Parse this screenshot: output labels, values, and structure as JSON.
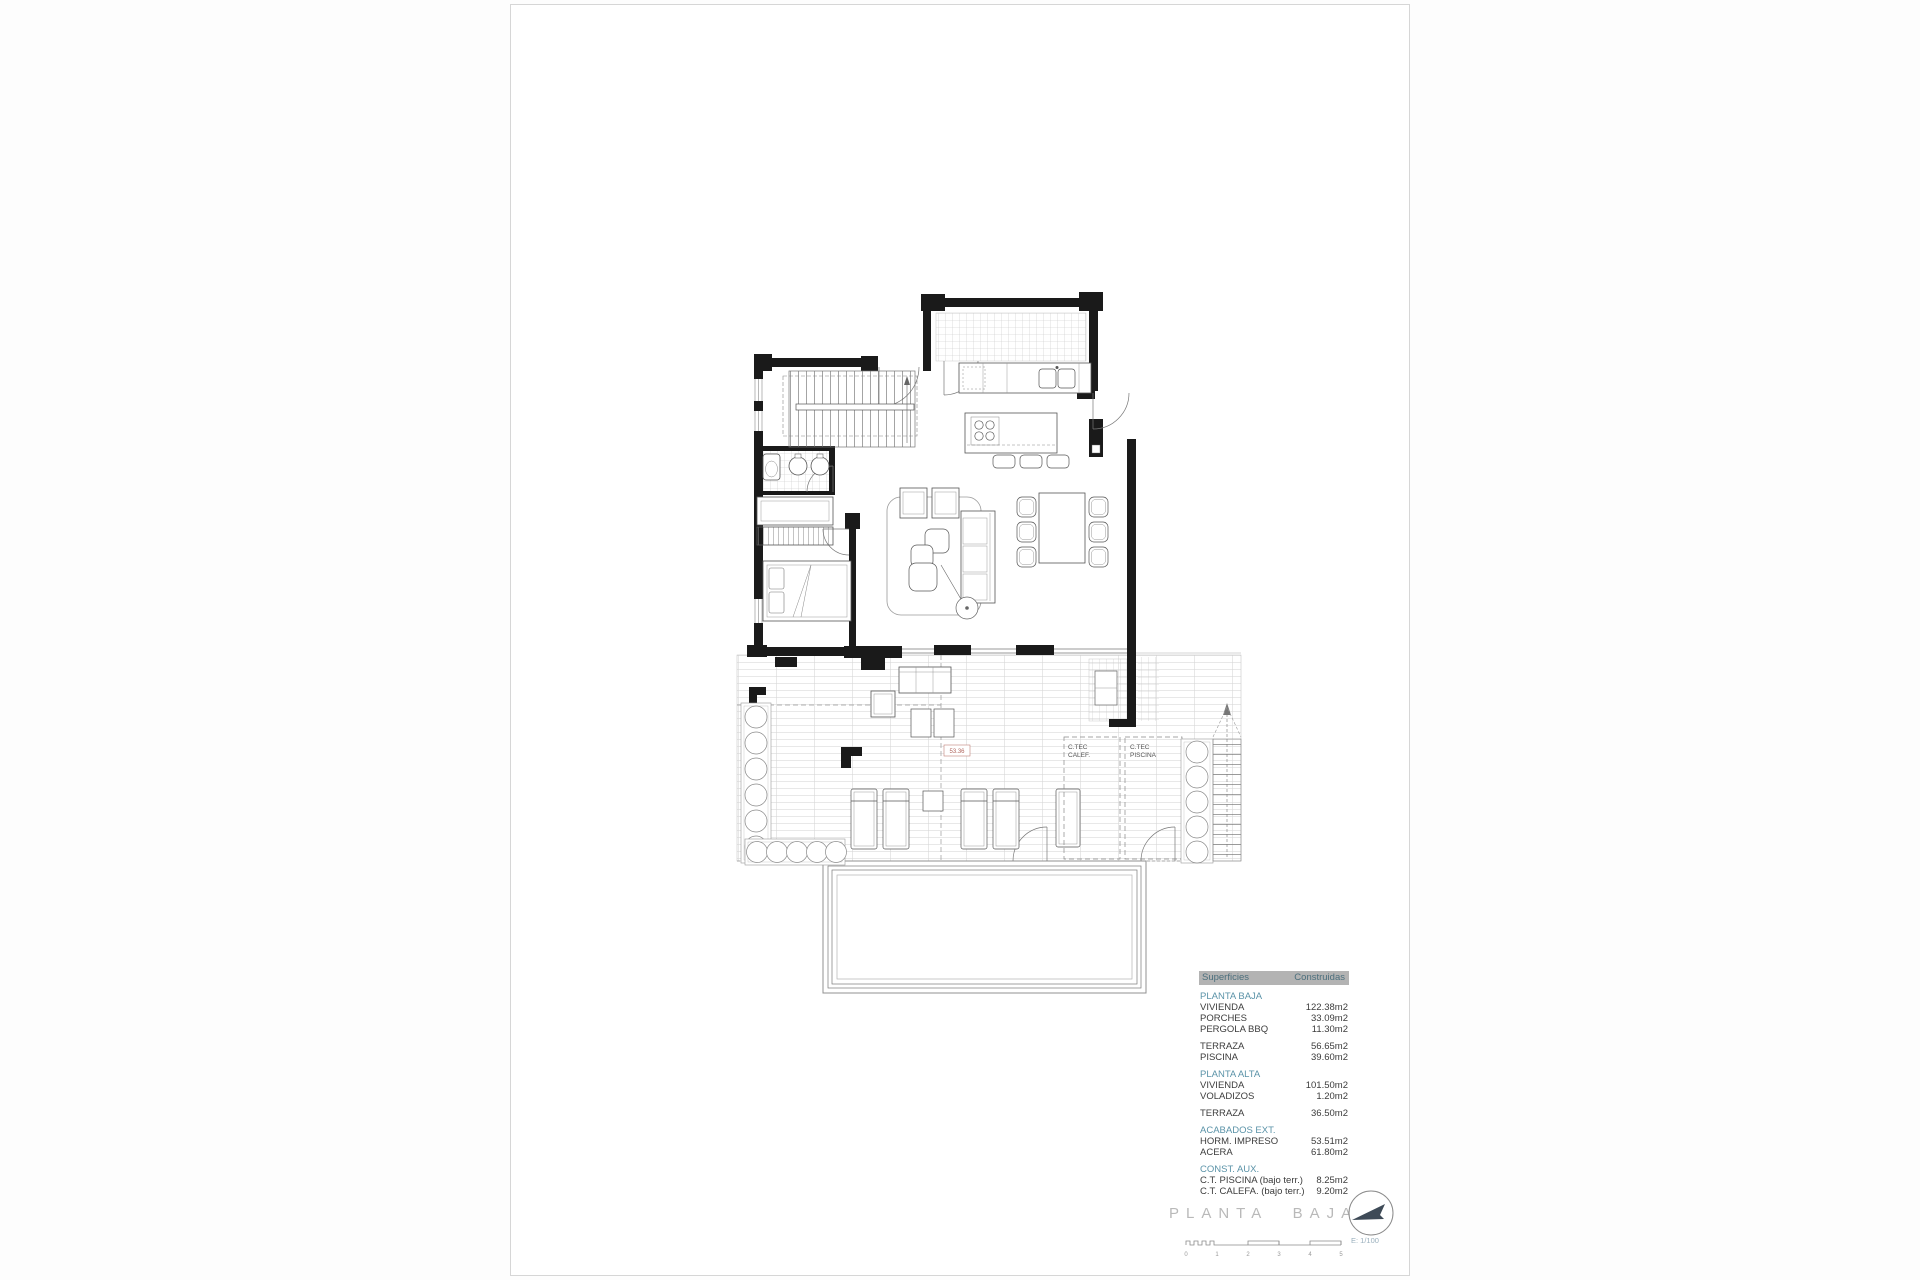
{
  "document": {
    "sheet_title": "PLANTA BAJA",
    "scale_label": "E: 1/100",
    "scale_ticks": [
      "0",
      "1",
      "2",
      "3",
      "4",
      "5"
    ]
  },
  "plan_labels": {
    "level_mark": "53.36",
    "room_calefaccion_line1": "C.TEC",
    "room_calefaccion_line2": "CALEF.",
    "room_piscina_line1": "C.TEC",
    "room_piscina_line2": "PISCINA"
  },
  "surfaces_table": {
    "col_superficies": "Superficies",
    "col_construidas": "Construidas",
    "rows": [
      {
        "type": "heading",
        "label": "PLANTA BAJA",
        "value": ""
      },
      {
        "type": "row",
        "label": "VIVIENDA",
        "value": "122.38m2"
      },
      {
        "type": "row",
        "label": "PORCHES",
        "value": "33.09m2"
      },
      {
        "type": "row",
        "label": "PERGOLA BBQ",
        "value": "11.30m2"
      },
      {
        "type": "row",
        "label": "TERRAZA",
        "value": "56.65m2"
      },
      {
        "type": "row",
        "label": "PISCINA",
        "value": "39.60m2"
      },
      {
        "type": "heading",
        "label": "PLANTA ALTA",
        "value": ""
      },
      {
        "type": "row",
        "label": "VIVIENDA",
        "value": "101.50m2"
      },
      {
        "type": "row",
        "label": "VOLADIZOS",
        "value": "1.20m2"
      },
      {
        "type": "row",
        "label": "TERRAZA",
        "value": "36.50m2"
      },
      {
        "type": "heading",
        "label": "ACABADOS EXT.",
        "value": ""
      },
      {
        "type": "row",
        "label": "HORM. IMPRESO",
        "value": "53.51m2"
      },
      {
        "type": "row",
        "label": "ACERA",
        "value": "61.80m2"
      },
      {
        "type": "heading",
        "label": "CONST. AUX.",
        "value": ""
      },
      {
        "type": "row",
        "label": "C.T. PISCINA (bajo terr.)",
        "value": "8.25m2"
      },
      {
        "type": "row",
        "label": "C.T. CALEFA. (bajo terr.)",
        "value": "9.20m2"
      }
    ],
    "colors": {
      "header_bg": "#b3b3b3",
      "header_text": "#4c6f7d",
      "section_heading": "#5b93a8",
      "title_text": "#b9b9b9",
      "level_mark": "#b0645c"
    }
  }
}
